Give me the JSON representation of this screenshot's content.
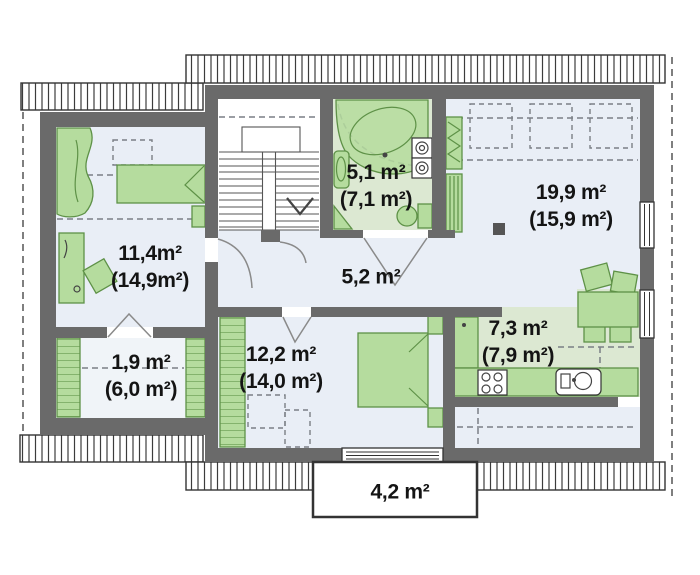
{
  "rooms": [
    {
      "name": "bedroom-left",
      "area": "11,4m²",
      "area_total": "(14,9m²)"
    },
    {
      "name": "wardrobe-room",
      "area": "1,9 m²",
      "area_total": "(6,0 m²)"
    },
    {
      "name": "bathroom",
      "area": "5,1 m²",
      "area_total": "(7,1 m²)"
    },
    {
      "name": "hallway",
      "area": "5,2 m²"
    },
    {
      "name": "living-room",
      "area": "19,9 m²",
      "area_total": "(15,9 m²)"
    },
    {
      "name": "bedroom-main",
      "area": "12,2 m²",
      "area_total": "(14,0 m²)"
    },
    {
      "name": "kitchen",
      "area": "7,3 m²",
      "area_total": "(7,9 m²)"
    },
    {
      "name": "balcony",
      "area": "4,2 m²"
    }
  ],
  "colors": {
    "wall": "#6a6a6a",
    "floor": "#e9eef6",
    "floor_green": "#dce8d2",
    "furniture": "#b5dc9e",
    "furniture_border": "#5e9147",
    "dash": "#7a7f85",
    "text": "#141414"
  }
}
